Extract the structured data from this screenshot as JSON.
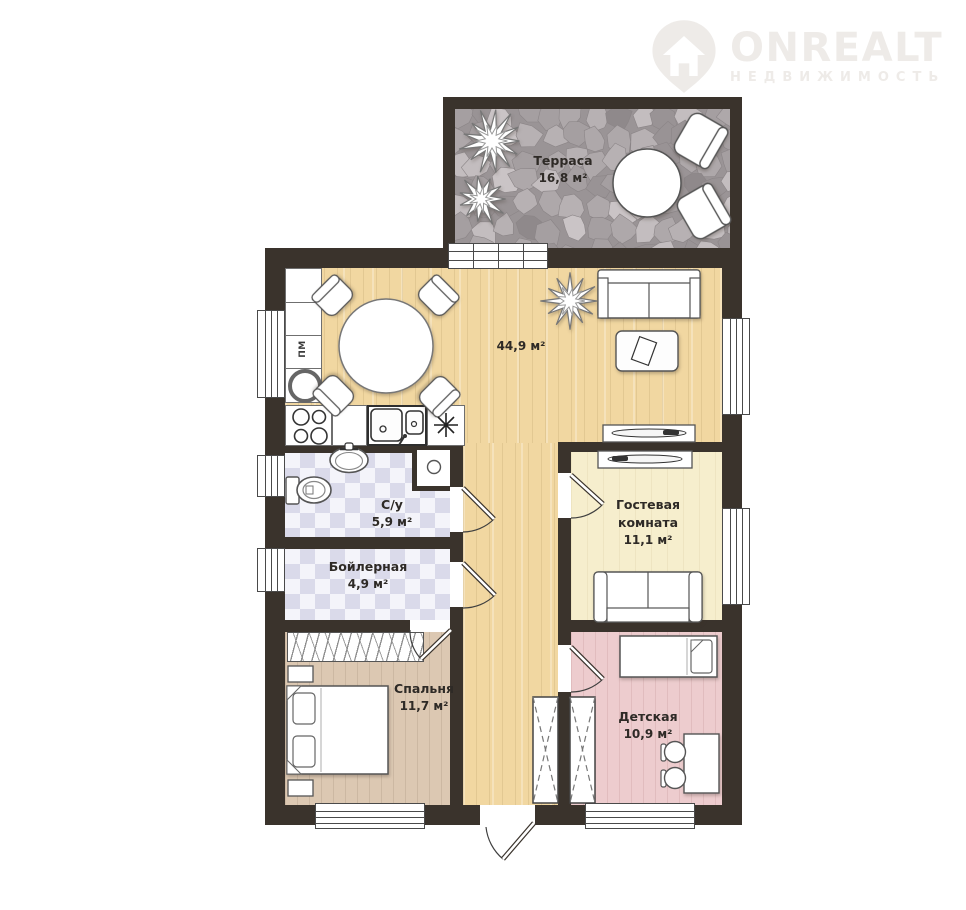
{
  "brand": {
    "name": "ONREALT",
    "tagline": "НЕДВИЖИМОСТЬ"
  },
  "labels": {
    "terrace": {
      "name": "Терраса",
      "area": "16,8 м²"
    },
    "living": {
      "area": "44,9 м²"
    },
    "bathroom": {
      "name": "С/у",
      "area": "5,9 м²"
    },
    "boiler": {
      "name": "Бойлерная",
      "area": "4,9 м²"
    },
    "guest": {
      "line1": "Гостевая",
      "line2": "комната",
      "area": "11,1 м²"
    },
    "bedroom": {
      "name": "Спальня",
      "area": "11,7 м²"
    },
    "kids": {
      "name": "Детская",
      "area": "10,9 м²"
    },
    "dishwasher": "ПМ"
  },
  "colors": {
    "wall": "#3a332c",
    "floor_living": "#f1d7a1",
    "floor_bedroom": "#dcc8b2",
    "floor_guest": "#f6eecd",
    "floor_kids": "#edccce",
    "tile_light": "#f4f4fa",
    "tile_dark": "#dadaea",
    "terrace_stone": "#a29c9e",
    "logo": "#eeebe8"
  }
}
